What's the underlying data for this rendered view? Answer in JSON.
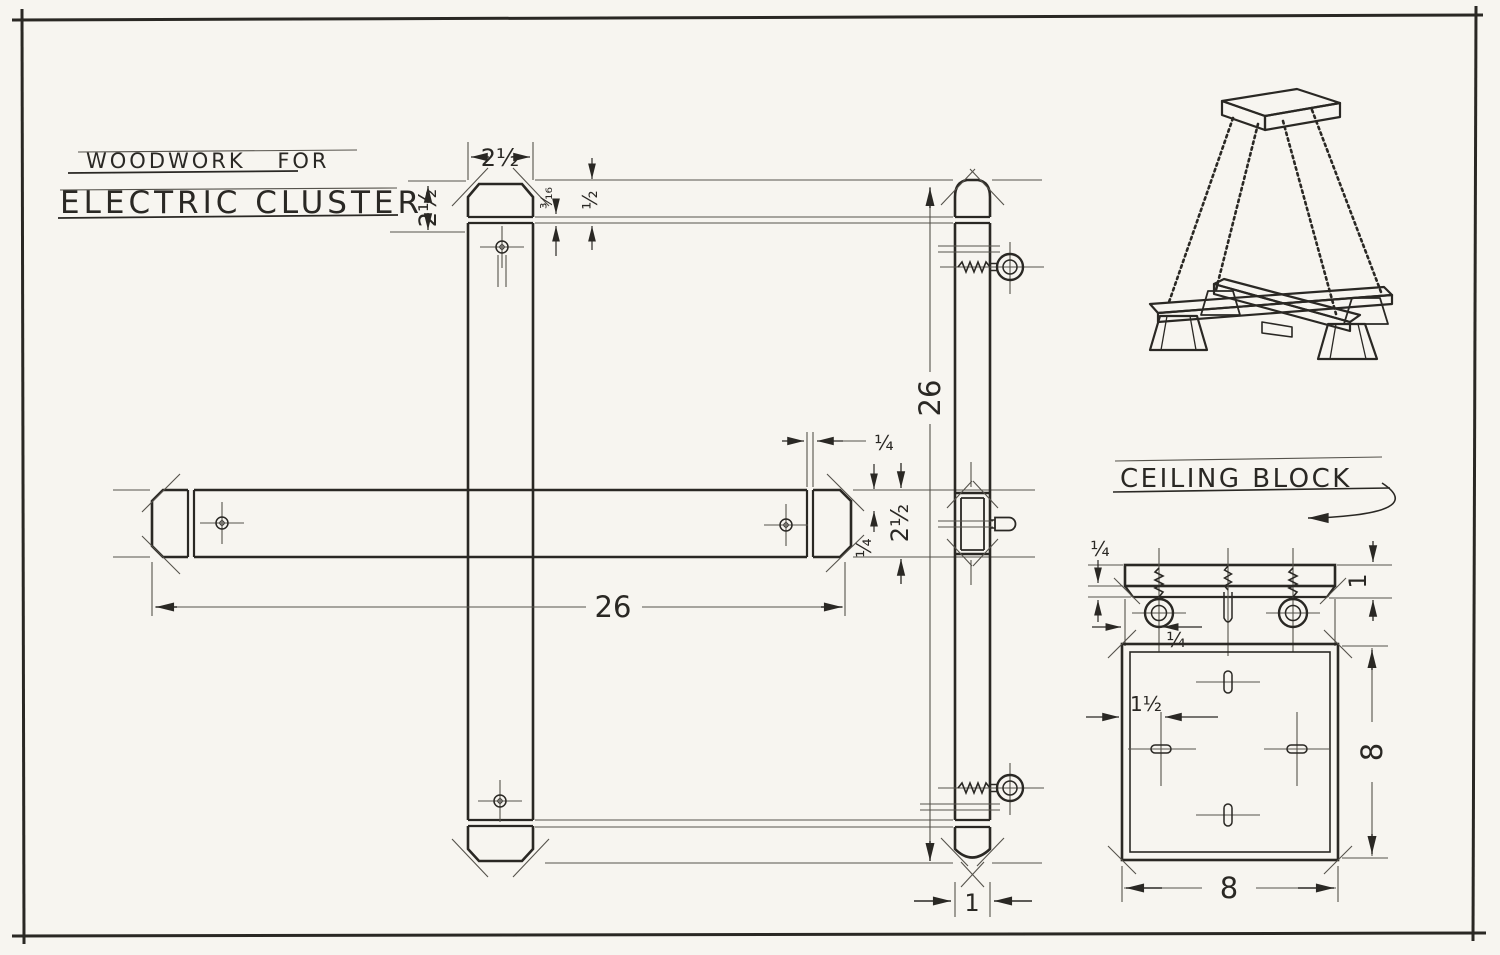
{
  "title": {
    "line1": "WOODWORK FOR",
    "line2": "ELECTRIC CLUSTER"
  },
  "labels": {
    "ceiling_block": "CEILING BLOCK"
  },
  "dims": {
    "arm_end_width": "2½",
    "cap_height": "2½",
    "cap_reveal": "³⁄₁₆",
    "cap_step": "½",
    "arm_length": "26",
    "arm_length_side": "26",
    "end_band": "¼",
    "lap_depth": "¼",
    "arm_face": "2½",
    "arm_thickness": "1",
    "block_lip": "¼",
    "screw_inset": "¼",
    "block_edge_thickness": "1",
    "slot_inset": "1½",
    "block_width": "8",
    "block_depth": "8"
  },
  "colors": {
    "paper": "#f7f5f0",
    "ink": "#2a2824",
    "hairline": "#55524b"
  }
}
